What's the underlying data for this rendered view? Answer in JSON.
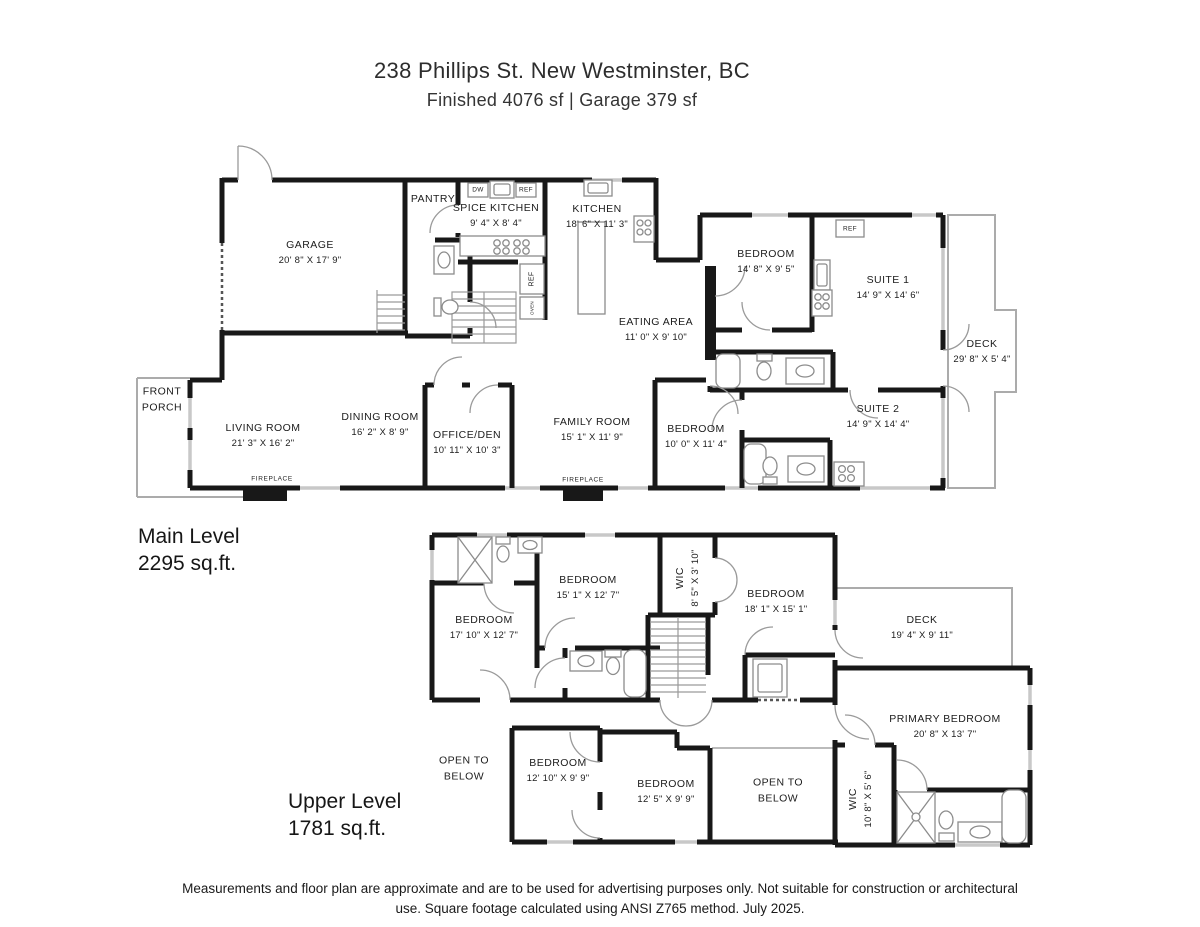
{
  "header": {
    "title": "238 Phillips St. New Westminster, BC",
    "subtitle": "Finished  4076 sf  |  Garage  379 sf"
  },
  "levels": [
    {
      "name": "Main Level",
      "area": "2295 sq.ft.",
      "rooms": [
        {
          "name": "GARAGE",
          "dims": "20' 8\" X 17' 9\""
        },
        {
          "name": "PANTRY",
          "dims": ""
        },
        {
          "name": "SPICE KITCHEN",
          "dims": "9' 4\" X 8' 4\""
        },
        {
          "name": "KITCHEN",
          "dims": "18' 6\" X 11' 3\""
        },
        {
          "name": "EATING AREA",
          "dims": "11' 0\" X 9' 10\""
        },
        {
          "name": "BEDROOM",
          "dims": "14' 8\" X 9' 5\""
        },
        {
          "name": "SUITE 1",
          "dims": "14' 9\" X 14' 6\""
        },
        {
          "name": "DECK",
          "dims": "29' 8\" X 5' 4\""
        },
        {
          "name": "SUITE 2",
          "dims": "14' 9\" X 14' 4\""
        },
        {
          "name": "BEDROOM",
          "dims": "10' 0\" X 11' 4\""
        },
        {
          "name": "FAMILY ROOM",
          "dims": "15' 1\" X 11' 9\""
        },
        {
          "name": "OFFICE/DEN",
          "dims": "10' 11\" X 10' 3\""
        },
        {
          "name": "DINING ROOM",
          "dims": "16' 2\" X 8' 9\""
        },
        {
          "name": "LIVING ROOM",
          "dims": "21' 3\" X 16' 2\""
        },
        {
          "name": "FRONT PORCH",
          "dims": ""
        }
      ]
    },
    {
      "name": "Upper Level",
      "area": "1781 sq.ft.",
      "rooms": [
        {
          "name": "BEDROOM",
          "dims": "17' 10\" X 12' 7\""
        },
        {
          "name": "BEDROOM",
          "dims": "15' 1\" X 12' 7\""
        },
        {
          "name": "WIC",
          "dims": "8' 5\" X 3' 10\""
        },
        {
          "name": "BEDROOM",
          "dims": "18' 1\" X 15' 1\""
        },
        {
          "name": "DECK",
          "dims": "19' 4\" X 9' 11\""
        },
        {
          "name": "PRIMARY BEDROOM",
          "dims": "20' 8\" X 13' 7\""
        },
        {
          "name": "WIC",
          "dims": "10' 8\" X 5' 6\""
        },
        {
          "name": "BEDROOM",
          "dims": "12' 10\" X 9' 9\""
        },
        {
          "name": "BEDROOM",
          "dims": "12' 5\" X 9' 9\""
        },
        {
          "name": "OPEN TO BELOW",
          "dims": ""
        },
        {
          "name": "OPEN TO BELOW",
          "dims": ""
        }
      ]
    }
  ],
  "fixture_labels": {
    "dw": "DW",
    "ref": "REF",
    "oven": "OVEN",
    "fireplace": "FIREPLACE"
  },
  "footer": {
    "line1": "Measurements and floor plan are approximate and are to be used for advertising purposes only. Not suitable for construction or architectural",
    "line2": "use. Square footage calculated using ANSI Z765 method. July 2025."
  }
}
